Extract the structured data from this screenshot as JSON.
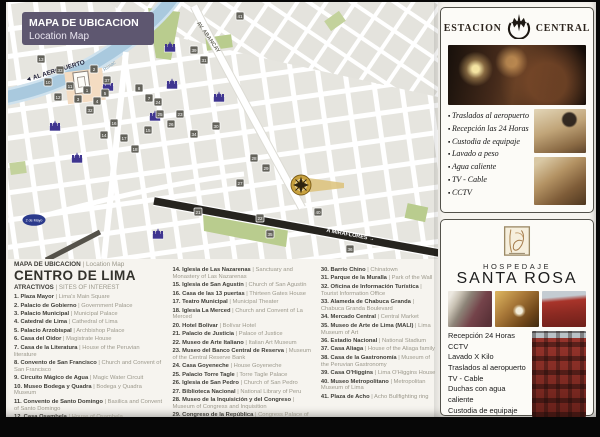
{
  "colors": {
    "banner_purple": "#5e5770",
    "marker_purple": "#3f3590",
    "river_blue": "#a9c9de",
    "map_green": "#b9cc8e",
    "gold_marker": "#c8a13e",
    "building_red": "#97342c"
  },
  "map": {
    "banner": {
      "title": "MAPA DE UBICACION",
      "subtitle": "Location Map"
    },
    "labels": {
      "airport": "◄ AL AEROPUERTO",
      "river": "Rio Rimac",
      "abancay": "AV. ABANCAY",
      "miraflores": "A MIRAFLORES →",
      "plaza_dos_de_mayo": "2 de Mayo"
    },
    "numbered_markers": [
      {
        "n": "13",
        "x": 33,
        "y": 57
      },
      {
        "n": "33",
        "x": 52,
        "y": 68
      },
      {
        "n": "10",
        "x": 40,
        "y": 80
      },
      {
        "n": "11",
        "x": 62,
        "y": 84
      },
      {
        "n": "2",
        "x": 86,
        "y": 67
      },
      {
        "n": "37",
        "x": 99,
        "y": 78
      },
      {
        "n": "1",
        "x": 79,
        "y": 88
      },
      {
        "n": "3",
        "x": 70,
        "y": 97
      },
      {
        "n": "4",
        "x": 89,
        "y": 99
      },
      {
        "n": "5",
        "x": 97,
        "y": 91
      },
      {
        "n": "12",
        "x": 50,
        "y": 95
      },
      {
        "n": "8",
        "x": 131,
        "y": 86
      },
      {
        "n": "7",
        "x": 141,
        "y": 96
      },
      {
        "n": "31",
        "x": 196,
        "y": 58
      },
      {
        "n": "39",
        "x": 186,
        "y": 48
      },
      {
        "n": "30",
        "x": 208,
        "y": 124
      },
      {
        "n": "34",
        "x": 186,
        "y": 132
      },
      {
        "n": "25",
        "x": 152,
        "y": 112
      },
      {
        "n": "26",
        "x": 163,
        "y": 122
      },
      {
        "n": "24",
        "x": 150,
        "y": 100
      },
      {
        "n": "23",
        "x": 172,
        "y": 112
      },
      {
        "n": "16",
        "x": 106,
        "y": 121
      },
      {
        "n": "17",
        "x": 116,
        "y": 136
      },
      {
        "n": "18",
        "x": 127,
        "y": 147
      },
      {
        "n": "15",
        "x": 140,
        "y": 128
      },
      {
        "n": "14",
        "x": 96,
        "y": 133
      },
      {
        "n": "32",
        "x": 82,
        "y": 108
      },
      {
        "n": "28",
        "x": 246,
        "y": 156
      },
      {
        "n": "29",
        "x": 258,
        "y": 166
      },
      {
        "n": "27",
        "x": 232,
        "y": 181
      },
      {
        "n": "21",
        "x": 190,
        "y": 210
      },
      {
        "n": "22",
        "x": 252,
        "y": 216
      },
      {
        "n": "35",
        "x": 262,
        "y": 232
      },
      {
        "n": "36",
        "x": 342,
        "y": 247
      },
      {
        "n": "40",
        "x": 310,
        "y": 210
      },
      {
        "n": "41",
        "x": 232,
        "y": 14
      }
    ],
    "church_markers": [
      {
        "x": 100,
        "y": 86
      },
      {
        "x": 162,
        "y": 47
      },
      {
        "x": 164,
        "y": 84
      },
      {
        "x": 211,
        "y": 97
      },
      {
        "x": 147,
        "y": 116
      },
      {
        "x": 47,
        "y": 126
      },
      {
        "x": 69,
        "y": 158
      },
      {
        "x": 150,
        "y": 234
      }
    ]
  },
  "legend": {
    "separator": " | ",
    "header_es": "MAPA DE UBICACION",
    "header_en": "| Location Map",
    "title": "CENTRO DE LIMA",
    "subtitle_es": "ATRACTIVOS",
    "subtitle_en": "| SITES OF INTEREST",
    "columns": [
      [
        {
          "n": "1.",
          "es": "Plaza Mayor",
          "en": "Lima's Main Square"
        },
        {
          "n": "2.",
          "es": "Palacio de Gobierno",
          "en": "Government Palace"
        },
        {
          "n": "3.",
          "es": "Palacio Municipal",
          "en": "Municipal Palace"
        },
        {
          "n": "4.",
          "es": "Catedral de Lima",
          "en": "Cathedral of Lima"
        },
        {
          "n": "5.",
          "es": "Palacio Arzobispal",
          "en": "Archbishop Palace"
        },
        {
          "n": "6.",
          "es": "Casa del Oidor",
          "en": "Magistrate House"
        },
        {
          "n": "7.",
          "es": "Casa de la Literatura",
          "en": "House of the Peruvian literature"
        },
        {
          "n": "8.",
          "es": "Convento de San Francisco",
          "en": "Church and Convent of San Francisco"
        },
        {
          "n": "9.",
          "es": "Circuito Mágico de Agua",
          "en": "Magic Water Circuit"
        },
        {
          "n": "10.",
          "es": "Museo Bodega y Quadra",
          "en": "Bodega y Quadra Museum"
        },
        {
          "n": "11.",
          "es": "Convento de Santo Domingo",
          "en": "Basilica and Convent of Santo Domingo"
        },
        {
          "n": "12.",
          "es": "Casa Osambela",
          "en": "House of Osambela"
        },
        {
          "n": "13.",
          "es": "Santuario de Santa Rosa de Lima",
          "en": "Sanctuary and Monastery of Santa Rosa of Lima"
        }
      ],
      [
        {
          "n": "14.",
          "es": "Iglesia de Las Nazarenas",
          "en": "Sanctuary and Monastery of Las Nazarenas"
        },
        {
          "n": "15.",
          "es": "Iglesia de San Agustín",
          "en": "Church of San Agustín"
        },
        {
          "n": "16.",
          "es": "Casa de las 13 puertas",
          "en": "Thirteen Gates House"
        },
        {
          "n": "17.",
          "es": "Teatro Municipal",
          "en": "Municipal Theater"
        },
        {
          "n": "18.",
          "es": "Iglesia La Merced",
          "en": "Church and Convent of La Merced"
        },
        {
          "n": "20.",
          "es": "Hotel Bolívar",
          "en": "Bolívar Hotel"
        },
        {
          "n": "21.",
          "es": "Palacio de Justicia",
          "en": "Palace of Justice"
        },
        {
          "n": "22.",
          "es": "Museo de Arte Italiano",
          "en": "Italian Art Museum"
        },
        {
          "n": "23.",
          "es": "Museo del Banco Central de Reserva",
          "en": "Museum of the Central Reserve Bank"
        },
        {
          "n": "24.",
          "es": "Casa Goyeneche",
          "en": "House Goyeneche"
        },
        {
          "n": "25.",
          "es": "Palacio Torre Tagle",
          "en": "Torre Tagle Palace"
        },
        {
          "n": "26.",
          "es": "Iglesia de San Pedro",
          "en": "Church of San Pedro"
        },
        {
          "n": "27.",
          "es": "Biblioteca Nacional",
          "en": "National Library of Peru"
        },
        {
          "n": "28.",
          "es": "Museo de la Inquisición y del Congreso",
          "en": "Museum of Congress and Inquisition"
        },
        {
          "n": "29.",
          "es": "Congreso de la República",
          "en": "Congress Palace of the Republic of Peru"
        }
      ],
      [
        {
          "n": "30.",
          "es": "Barrio Chino",
          "en": "Chinatown"
        },
        {
          "n": "31.",
          "es": "Parque de la Muralla",
          "en": "Park of the Wall"
        },
        {
          "n": "32.",
          "es": "Oficina de Información Turística",
          "en": "Tourist Information Office"
        },
        {
          "n": "33.",
          "es": "Alameda de Chabuca Granda",
          "en": "Chabuca Granda Boulevard"
        },
        {
          "n": "34.",
          "es": "Mercado Central",
          "en": "Central Market"
        },
        {
          "n": "35.",
          "es": "Museo de Arte de Lima (MALI)",
          "en": "Lima Museum of Art"
        },
        {
          "n": "36.",
          "es": "Estadio Nacional",
          "en": "National Stadium"
        },
        {
          "n": "37.",
          "es": "Casa Aliaga",
          "en": "House of the Aliaga family"
        },
        {
          "n": "38.",
          "es": "Casa de la Gastronomía",
          "en": "Museum of the Peruvian Gastronomy"
        },
        {
          "n": "39.",
          "es": "Casa O'Higgins",
          "en": "Lima O'Higgins House"
        },
        {
          "n": "40.",
          "es": "Museo Metropolitano",
          "en": "Metropolitan Museum of Lima"
        },
        {
          "n": "41.",
          "es": "Plaza de Acho",
          "en": "Acho Bullfighting ring"
        }
      ]
    ]
  },
  "panels": {
    "estacion": {
      "title_left": "ESTACION",
      "title_right": "CENTRAL",
      "services": [
        "Traslados al aeropuerto",
        "Recepción las 24 Horas",
        "Custodia de equipaje",
        "Lavado a peso",
        "Agua caliente",
        "TV - Cable",
        "CCTV"
      ]
    },
    "santarosa": {
      "title_top": "HOSPEDAJE",
      "title_main": "SANTA ROSA",
      "services": [
        "Recepción 24 Horas",
        "CCTV",
        "Lavado X Kilo",
        "Traslados al aeropuerto",
        "TV - Cable",
        "Duchas con agua caliente",
        "Custodia de equipaje"
      ]
    }
  }
}
